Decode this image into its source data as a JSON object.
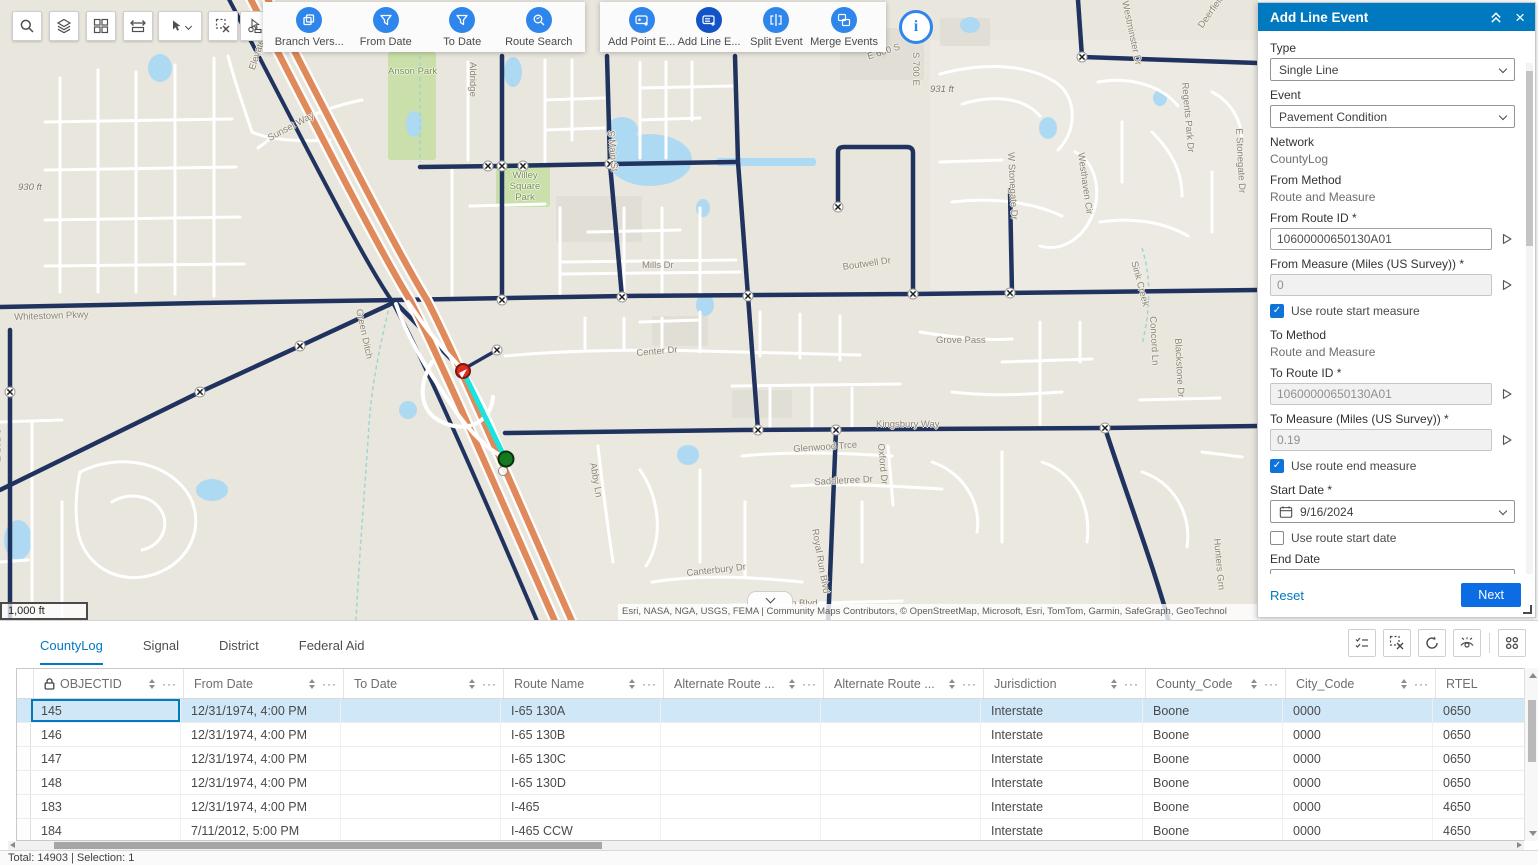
{
  "colors": {
    "accent_blue": "#0079c1",
    "tool_blue": "#2e86ec",
    "tool_blue_active": "#1254c8",
    "selection_cyan": "#18e5df",
    "marker_red": "#e02b1f",
    "marker_green": "#157a1f",
    "highway_orange": "#e08a5c",
    "selected_row": "#cfe7f7"
  },
  "toolbar_left": {
    "buttons": [
      "search",
      "layers",
      "basemap-grid",
      "measure",
      "select",
      "clear-selection",
      "select-route"
    ]
  },
  "map_tools": {
    "groups": [
      {
        "items": [
          {
            "label": "Branch Vers...",
            "icon": "branch-versions",
            "active": false
          },
          {
            "label": "From Date",
            "icon": "filter",
            "active": false
          },
          {
            "label": "To Date",
            "icon": "filter",
            "active": false
          },
          {
            "label": "Route Search",
            "icon": "route-search",
            "active": false
          }
        ]
      },
      {
        "items": [
          {
            "label": "Add Point E...",
            "icon": "add-point-event",
            "active": false
          },
          {
            "label": "Add Line E...",
            "icon": "add-line-event",
            "active": true
          },
          {
            "label": "Split Event",
            "icon": "split-event",
            "active": false
          },
          {
            "label": "Merge Events",
            "icon": "merge-events",
            "active": false
          }
        ]
      }
    ],
    "info_button_icon": "info"
  },
  "map": {
    "scale_label": "1,000 ft",
    "attribution": "Esri, NASA, NGA, USGS, FEMA | Community Maps Contributors, © OpenStreetMap, Microsoft, Esri, TomTom, Garmin, SafeGraph, GeoTechnol",
    "labels": [
      {
        "t": "Anson Park",
        "x": 388,
        "y": 66,
        "r": 0,
        "c": "green"
      },
      {
        "t": "Willey Square Park",
        "x": 500,
        "y": 170,
        "r": 0,
        "c": "green",
        "w": 50
      },
      {
        "t": "Aldridge",
        "x": 478,
        "y": 62,
        "r": 90
      },
      {
        "t": "S Main St",
        "x": 616,
        "y": 130,
        "r": 85
      },
      {
        "t": "Elevated Way",
        "x": 247,
        "y": 68,
        "r": -72
      },
      {
        "t": "Sunset Way",
        "x": 266,
        "y": 134,
        "r": -28
      },
      {
        "t": "E 600 S",
        "x": 866,
        "y": 52,
        "r": -18
      },
      {
        "t": "931 ft",
        "x": 930,
        "y": 84,
        "r": 0,
        "c": "elev"
      },
      {
        "t": "930 ft",
        "x": 18,
        "y": 182,
        "r": 0,
        "c": "elev"
      },
      {
        "t": "S 700 E",
        "x": 921,
        "y": 52,
        "r": 90
      },
      {
        "t": "Westhaven Cir",
        "x": 1086,
        "y": 152,
        "r": 82
      },
      {
        "t": "Regents Park Dr",
        "x": 1190,
        "y": 82,
        "r": 85
      },
      {
        "t": "Deerfield Ln",
        "x": 1196,
        "y": 24,
        "r": -55
      },
      {
        "t": "Westminster Dr",
        "x": 1130,
        "y": 0,
        "r": 78
      },
      {
        "t": "W Stonegate Dr",
        "x": 1016,
        "y": 152,
        "r": 87
      },
      {
        "t": "E Stonegate Dr",
        "x": 1244,
        "y": 128,
        "r": 87
      },
      {
        "t": "Mills Dr",
        "x": 642,
        "y": 260,
        "r": 0
      },
      {
        "t": "Boutwell Dr",
        "x": 842,
        "y": 262,
        "r": -8
      },
      {
        "t": "Center Dr",
        "x": 636,
        "y": 348,
        "r": -5
      },
      {
        "t": "Grove Pass",
        "x": 936,
        "y": 335,
        "r": 0
      },
      {
        "t": "Concord Ln",
        "x": 1158,
        "y": 316,
        "r": 87
      },
      {
        "t": "Blackstone Dr",
        "x": 1183,
        "y": 338,
        "r": 87
      },
      {
        "t": "Sink Creek",
        "x": 1139,
        "y": 260,
        "r": 75
      },
      {
        "t": "Kingsbury Way",
        "x": 876,
        "y": 419,
        "r": 0
      },
      {
        "t": "Glenwood Trce",
        "x": 793,
        "y": 444,
        "r": -4
      },
      {
        "t": "Saddletree Dr",
        "x": 814,
        "y": 477,
        "r": -3
      },
      {
        "t": "Abby Ln",
        "x": 598,
        "y": 462,
        "r": 80
      },
      {
        "t": "Oxford Dr",
        "x": 886,
        "y": 443,
        "r": 85
      },
      {
        "t": "Royal Run Blvd",
        "x": 820,
        "y": 528,
        "r": 80
      },
      {
        "t": "Royal Run Blvd",
        "x": 752,
        "y": 598,
        "r": 0
      },
      {
        "t": "Canterbury Dr",
        "x": 686,
        "y": 568,
        "r": -6
      },
      {
        "t": "Hunters Grn",
        "x": 1222,
        "y": 538,
        "r": 85
      },
      {
        "t": "Green Ditch",
        "x": 364,
        "y": 308,
        "r": 78
      },
      {
        "t": "S 525 E",
        "x": 2,
        "y": 428,
        "r": 90
      },
      {
        "t": "Whitestown Pkwy",
        "x": 14,
        "y": 312,
        "r": -2
      }
    ]
  },
  "panel": {
    "title": "Add Line Event",
    "type": {
      "label": "Type",
      "value": "Single Line"
    },
    "event": {
      "label": "Event",
      "value": "Pavement Condition"
    },
    "network": {
      "label": "Network",
      "value": "CountyLog"
    },
    "from_method": {
      "label": "From Method",
      "value": "Route and Measure"
    },
    "from_route_id": {
      "label": "From Route ID *",
      "value": "10600000650130A01"
    },
    "from_measure": {
      "label": "From Measure (Miles (US Survey)) *",
      "value": "0"
    },
    "use_route_start_measure": {
      "label": "Use route start measure",
      "checked": true
    },
    "to_method": {
      "label": "To Method",
      "value": "Route and Measure"
    },
    "to_route_id": {
      "label": "To Route ID *",
      "value": "10600000650130A01"
    },
    "to_measure": {
      "label": "To Measure (Miles (US Survey)) *",
      "value": "0.19"
    },
    "use_route_end_measure": {
      "label": "Use route end measure",
      "checked": true
    },
    "start_date": {
      "label": "Start Date *",
      "value": "9/16/2024"
    },
    "use_route_start_date": {
      "label": "Use route start date",
      "checked": false
    },
    "end_date": {
      "label": "End Date",
      "placeholder": "MM/DD/YYYY"
    },
    "use_route_end_date": {
      "label": "Use route end date",
      "checked": false
    },
    "reset_label": "Reset",
    "next_label": "Next"
  },
  "tabs": [
    {
      "label": "CountyLog",
      "active": true
    },
    {
      "label": "Signal",
      "active": false
    },
    {
      "label": "District",
      "active": false
    },
    {
      "label": "Federal Aid",
      "active": false
    }
  ],
  "table_toolbar": {
    "buttons": [
      "show-selected",
      "clear-selection",
      "refresh",
      "hide-fields",
      "field-options"
    ]
  },
  "table": {
    "columns": [
      {
        "label": "",
        "sortable": false,
        "strip": true
      },
      {
        "label": "OBJECTID",
        "locked": true,
        "sortable": true
      },
      {
        "label": "From Date",
        "sortable": true
      },
      {
        "label": "To Date",
        "sortable": true
      },
      {
        "label": "Route Name",
        "sortable": true
      },
      {
        "label": "Alternate Route ...",
        "sortable": true
      },
      {
        "label": "Alternate Route ...",
        "sortable": true
      },
      {
        "label": "Jurisdiction",
        "sortable": true
      },
      {
        "label": "County_Code",
        "sortable": true
      },
      {
        "label": "City_Code",
        "sortable": true
      },
      {
        "label": "RTEL",
        "sortable": false
      }
    ],
    "rows": [
      {
        "selected": true,
        "cells": [
          "145",
          "12/31/1974, 4:00 PM",
          "",
          "I-65 130A",
          "",
          "",
          "Interstate",
          "Boone",
          "0000",
          "0650"
        ]
      },
      {
        "selected": false,
        "cells": [
          "146",
          "12/31/1974, 4:00 PM",
          "",
          "I-65 130B",
          "",
          "",
          "Interstate",
          "Boone",
          "0000",
          "0650"
        ]
      },
      {
        "selected": false,
        "cells": [
          "147",
          "12/31/1974, 4:00 PM",
          "",
          "I-65 130C",
          "",
          "",
          "Interstate",
          "Boone",
          "0000",
          "0650"
        ]
      },
      {
        "selected": false,
        "cells": [
          "148",
          "12/31/1974, 4:00 PM",
          "",
          "I-65 130D",
          "",
          "",
          "Interstate",
          "Boone",
          "0000",
          "0650"
        ]
      },
      {
        "selected": false,
        "cells": [
          "183",
          "12/31/1974, 4:00 PM",
          "",
          "I-465",
          "",
          "",
          "Interstate",
          "Boone",
          "0000",
          "4650"
        ]
      },
      {
        "selected": false,
        "cells": [
          "184",
          "7/11/2012, 5:00 PM",
          "",
          "I-465 CCW",
          "",
          "",
          "Interstate",
          "Boone",
          "0000",
          "4650"
        ]
      }
    ]
  },
  "status_bar": {
    "text": "Total: 14903 | Selection: 1"
  }
}
